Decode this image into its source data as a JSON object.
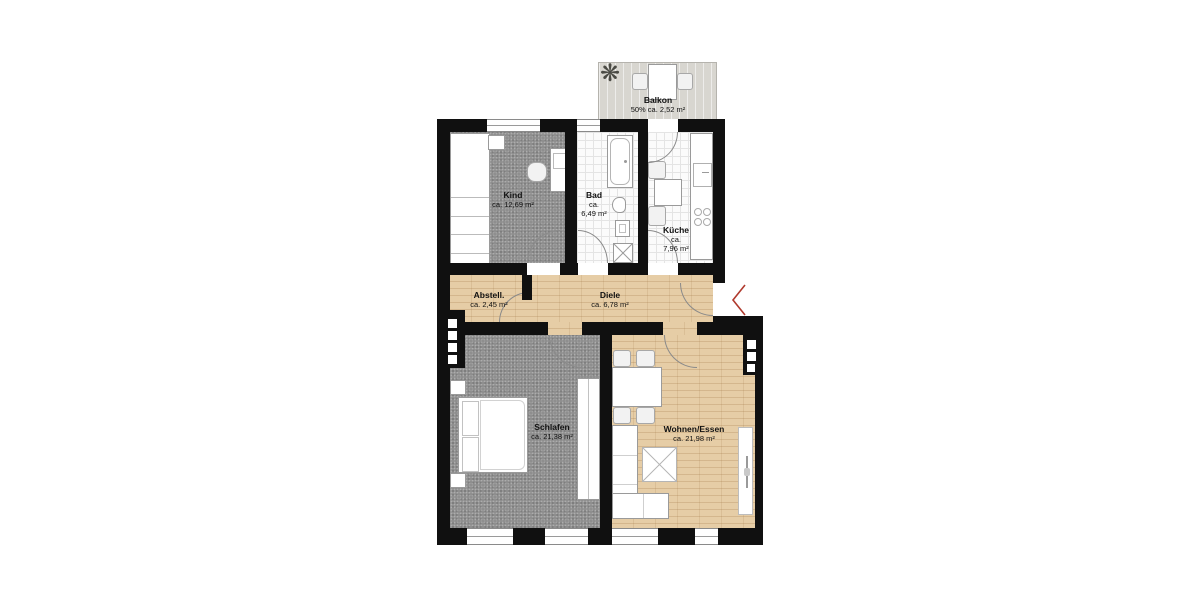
{
  "plan_type": "apartment-floor-plan",
  "colors": {
    "wall": "#101010",
    "carpet": "#8e8e8e",
    "wood": "#e6cda6",
    "tile-line": "#e4e4e4",
    "balcony": "#d8d6d0",
    "outline": "#9a9a9a",
    "accent-red": "#b03a2e",
    "text": "#111111"
  },
  "balcony": {
    "lines": [
      "Balkon",
      "50% ca. 2,52 m²"
    ]
  },
  "rooms": [
    {
      "id": "kind",
      "lines": [
        "Kind",
        "ca. 12,69 m²"
      ]
    },
    {
      "id": "bad",
      "lines": [
        "Bad",
        "ca.",
        "6,49 m²"
      ]
    },
    {
      "id": "kueche",
      "lines": [
        "Küche",
        "ca.",
        "7,96 m²"
      ]
    },
    {
      "id": "abstell",
      "lines": [
        "Abstell.",
        "ca. 2,45 m²"
      ]
    },
    {
      "id": "diele",
      "lines": [
        "Diele",
        "ca. 6,78 m²"
      ]
    },
    {
      "id": "schlafen",
      "lines": [
        "Schlafen",
        "ca. 21,38 m²"
      ]
    },
    {
      "id": "wohnen",
      "lines": [
        "Wohnen/Essen",
        "ca. 21,98 m²"
      ]
    }
  ],
  "icons": {
    "plant": "❋"
  }
}
